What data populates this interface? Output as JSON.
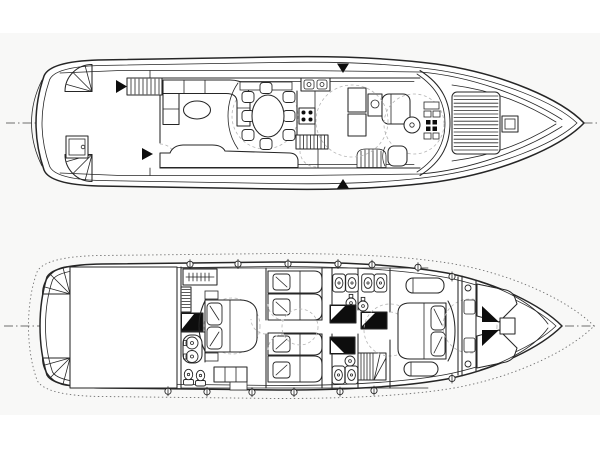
{
  "diagram": {
    "kind": "motor-yacht-deck-plans-line-drawing",
    "orientation": "bow-right",
    "colors": {
      "paper": "#ffffff",
      "tint": "#f8f8f7",
      "ink": "#262626",
      "ink-light": "#6e6e6e",
      "ink-faint": "#b5b5b5",
      "black-fill": "#0d0d0d",
      "white-fill": "#ffffff"
    },
    "plans": [
      {
        "id": "main-deck",
        "features": [
          "aft deck",
          "stern corner steps (2)",
          "deck hatch",
          "flybridge stairs with arrow",
          "salon L-sofa",
          "oval coffee table",
          "aft salon sofa",
          "oval dining table",
          "dining chairs (8)",
          "sideboard",
          "galley counter",
          "galley sink",
          "4-burner stove",
          "companionway stairs",
          "refrigerator cabinets",
          "dinette settee",
          "helm console",
          "steering wheel",
          "helm seat",
          "curved windshield",
          "side-deck gate arrows (2)",
          "foredeck sun pad",
          "anchor windlass",
          "centerline"
        ]
      },
      {
        "id": "lower-deck",
        "features": [
          "swim platform (dotted)",
          "stern corner steps (2)",
          "engine room",
          "master cabin double bed",
          "wardrobe with hangers",
          "master shower",
          "twin-sink vanity",
          "toilets (2)",
          "dresser",
          "guest cabin port beds (2)",
          "guest cabin starboard beds (2)",
          "guest bathrooms (3)",
          "shower stalls (3)",
          "washbasins (2)",
          "staircase",
          "corridor",
          "VIP double bed",
          "VIP settees (2)",
          "crew V-berths (2)",
          "crew table",
          "portholes (12)",
          "deck-edge dotted line",
          "centerline"
        ]
      }
    ]
  }
}
